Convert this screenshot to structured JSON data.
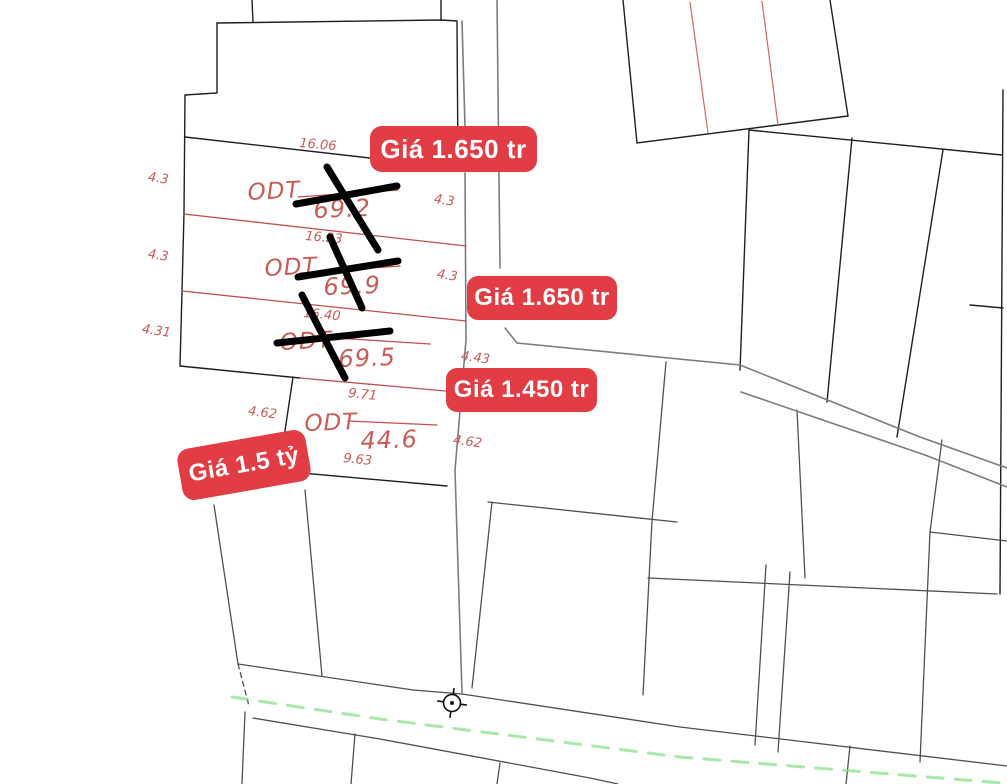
{
  "map": {
    "type": "cadastral-parcel-map",
    "background": "#ffffff",
    "colors": {
      "parcel_boundary_black": "#1f1f1f",
      "secondary_boundary_gray": "#4f4f4f",
      "lane_gray": "#7c7c7c",
      "cadastral_red_line": "#c0504d",
      "label_red": "#c75b57",
      "badge_red": "#e23c44",
      "badge_text": "#ffffff",
      "centerline_green": "#8ee08e",
      "cross_mark_black": "#000000"
    },
    "parcels": [
      {
        "land_use": "ODT",
        "area": "69.2",
        "sold_crossed_out": true,
        "dims": {
          "top": "16.06",
          "left": "4.3",
          "right": "4.3"
        }
      },
      {
        "land_use": "ODT",
        "area": "69.9",
        "sold_crossed_out": true,
        "dims": {
          "top": "16.23",
          "left": "4.3",
          "right": "4.3"
        }
      },
      {
        "land_use": "ODT",
        "area": "69.5",
        "sold_crossed_out": true,
        "dims": {
          "top": "16.40",
          "left": "4.31",
          "right": "4.43"
        }
      },
      {
        "land_use": "ODT",
        "area": "44.6",
        "sold_crossed_out": false,
        "dims": {
          "top": "9.71",
          "left": "4.62",
          "right": "4.62",
          "bottom": "9.63"
        }
      }
    ],
    "price_labels": [
      {
        "text": "Giá 1.650 tr"
      },
      {
        "text": "Giá 1.650 tr"
      },
      {
        "text": "Giá 1.450 tr"
      },
      {
        "text": "Giá 1.5 tỷ"
      }
    ],
    "symbols": [
      {
        "name": "survey-marker"
      }
    ]
  }
}
